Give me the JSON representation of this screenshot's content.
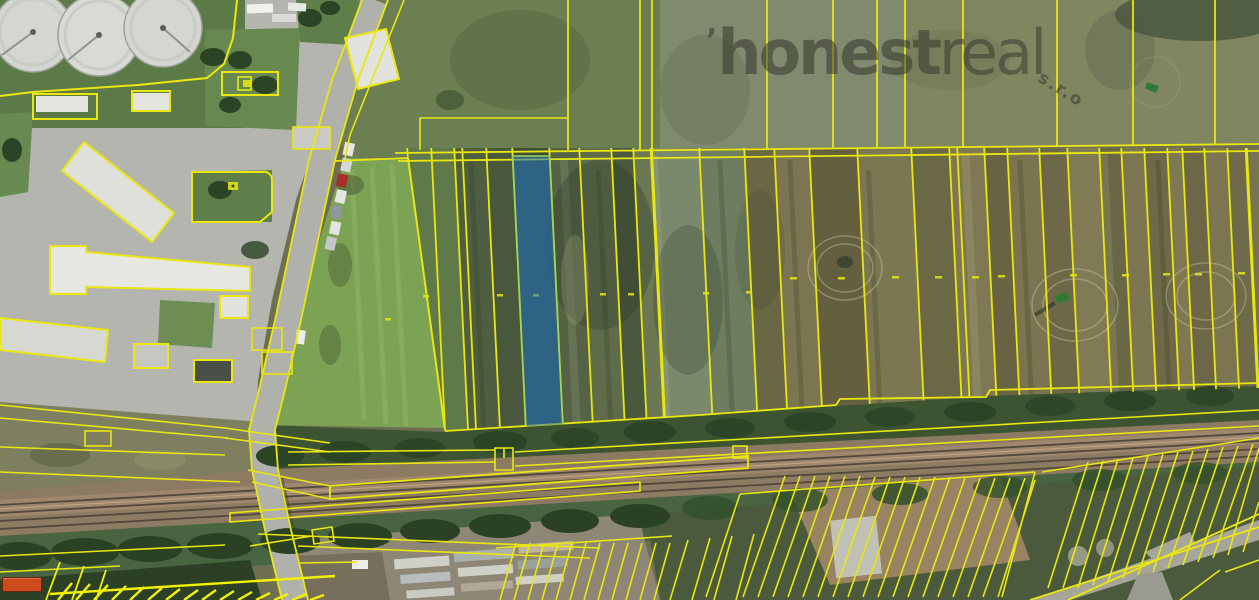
{
  "page": {
    "type": "aerial-cadastral-map",
    "width_px": 1259,
    "height_px": 600
  },
  "watermark": {
    "mark": "ʼ",
    "brand_bold": "honest",
    "brand_light": "real",
    "brand_suffix": "s.r.o"
  },
  "colors": {
    "cadastral_line": "#e9e70f",
    "cadastral_bright": "#f2f200",
    "highlight_fill": "#2377c2",
    "highlight_stroke": "#a4d455",
    "watermark_text": "#33332b",
    "badge_background": "#cc4a1c",
    "badge_border": "#6b2408"
  },
  "highlighted_parcel": {
    "shape": "narrow vertical strip parcel",
    "fill_opacity": 0.55
  }
}
